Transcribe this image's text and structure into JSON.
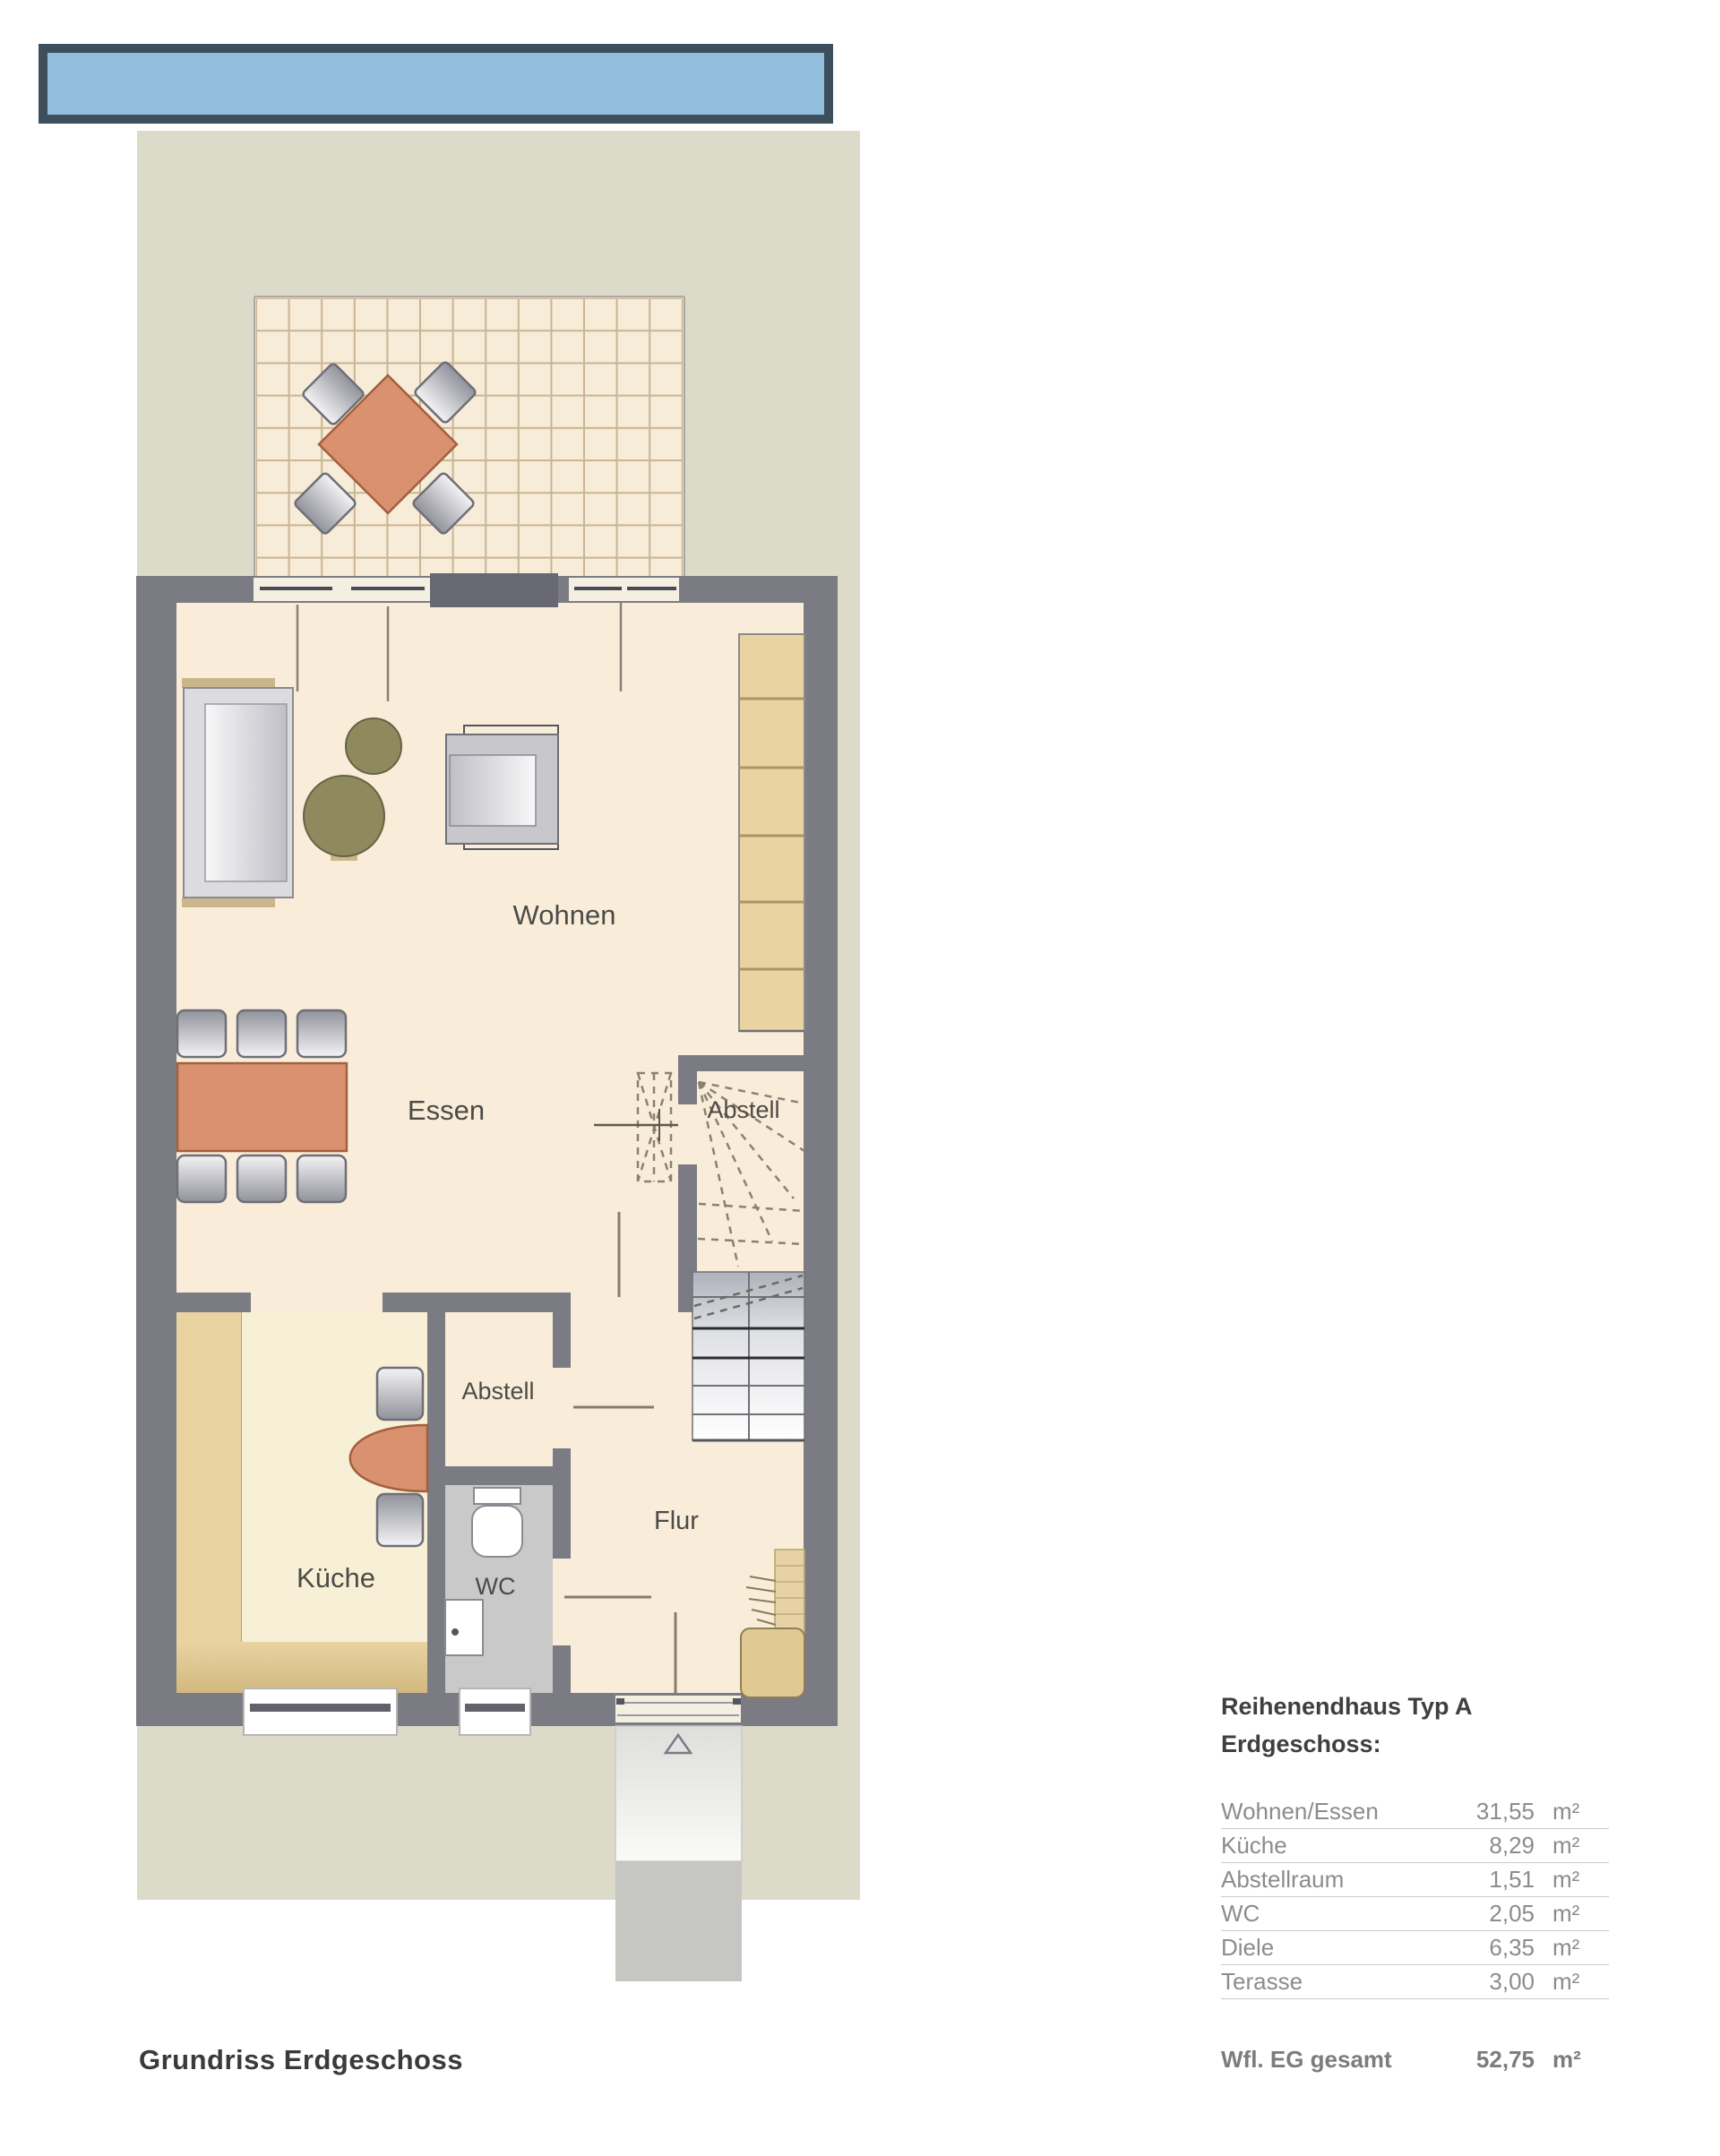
{
  "banner": {
    "fill": "#92bedd",
    "border": "#3d4f5c"
  },
  "plan": {
    "labels": {
      "wohnen": "Wohnen",
      "essen": "Essen",
      "kueche": "Küche",
      "wc": "WC",
      "flur": "Flur",
      "abstell_stairs": "Abstell",
      "abstell_kitchen": "Abstell"
    },
    "colors": {
      "garden": "#dcdbca",
      "floor": "#f9edda",
      "kitchen_floor": "#f8f0d6",
      "wall": "#7b7b84",
      "furniture_accent": "#d9916f",
      "wood": "#e9d3a1",
      "plant": "#8f8a5e",
      "wc_floor": "#c9c9c9"
    }
  },
  "legend": {
    "title_line1": "Reihenendhaus Typ A",
    "title_line2": "Erdgeschoss:",
    "rows": [
      {
        "label": "Wohnen/Essen",
        "value": "31,55",
        "unit": "m²"
      },
      {
        "label": "Küche",
        "value": "8,29",
        "unit": "m²"
      },
      {
        "label": "Abstellraum",
        "value": "1,51",
        "unit": "m²"
      },
      {
        "label": "WC",
        "value": "2,05",
        "unit": "m²"
      },
      {
        "label": "Diele",
        "value": "6,35",
        "unit": "m²"
      },
      {
        "label": "Terasse",
        "value": "3,00",
        "unit": "m²"
      }
    ],
    "total": {
      "label": "Wfl. EG gesamt",
      "value": "52,75",
      "unit": "m²"
    }
  },
  "footer": {
    "title": "Grundriss Erdgeschoss"
  }
}
